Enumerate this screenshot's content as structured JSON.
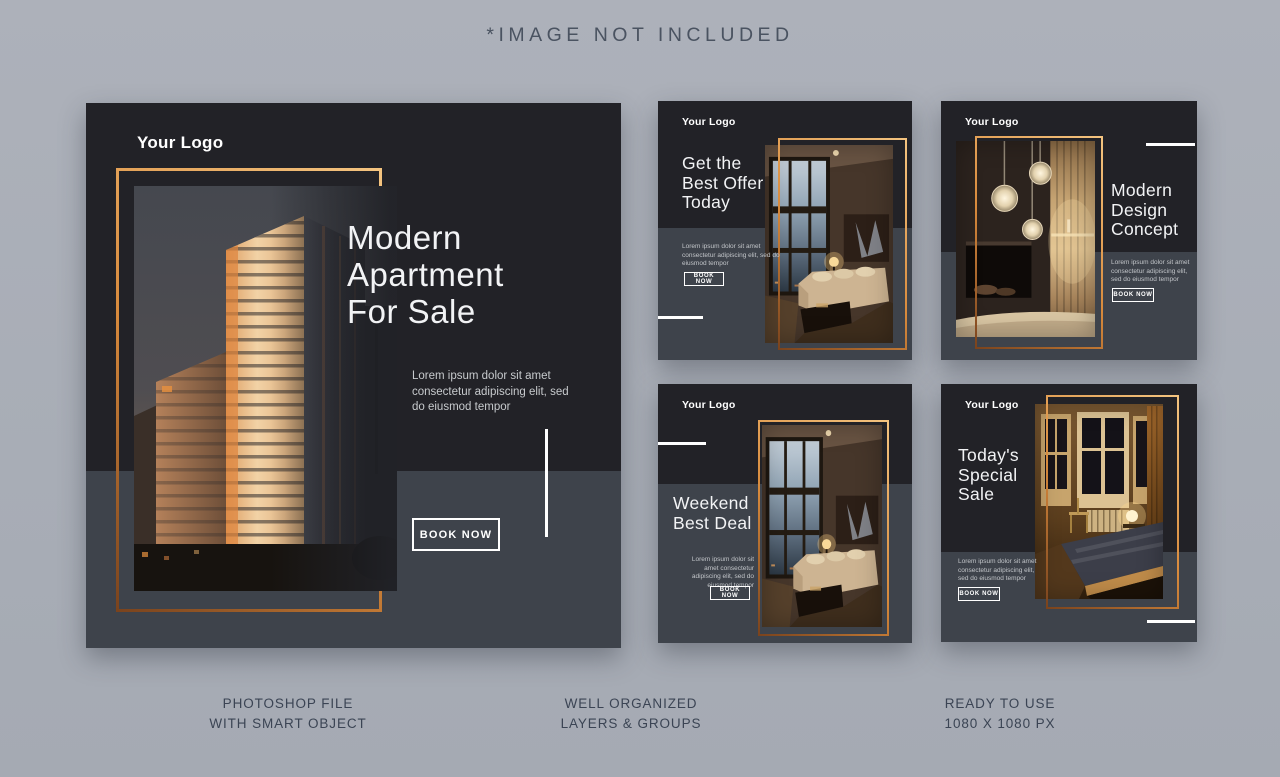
{
  "page": {
    "disclaimer": "*IMAGE NOT INCLUDED",
    "background": "#a9aeb7"
  },
  "colors": {
    "card_dark": "#222227",
    "card_light": "#3e434b",
    "gold_accent": "#d88a3c",
    "white": "#ffffff",
    "caption_text": "#3b4454"
  },
  "cards": {
    "main": {
      "logo": "Your Logo",
      "title_lines": [
        "Modern",
        "Apartment",
        "For Sale"
      ],
      "body": "Lorem ipsum dolor sit amet consectetur adipiscing elit, sed do eiusmod tempor",
      "cta": "BOOK NOW",
      "photo": "building-exterior-sunset"
    },
    "top_middle": {
      "logo": "Your Logo",
      "title_lines": [
        "Get the",
        "Best Offer",
        "Today"
      ],
      "body": "Lorem ipsum dolor sit amet consectetur adipiscing elit, sed do eiusmod tempor",
      "cta": "BOOK NOW",
      "photo": "living-room-interior"
    },
    "top_right": {
      "logo": "Your Logo",
      "title_lines": [
        "Modern",
        "Design",
        "Concept"
      ],
      "body": "Lorem ipsum dolor sit amet consectetur adipiscing elit, sed do eiusmod tempor",
      "cta": "BOOK NOW",
      "photo": "pendant-lights-interior"
    },
    "bottom_middle": {
      "logo": "Your Logo",
      "title_lines": [
        "Weekend",
        "Best Deal"
      ],
      "body": "Lorem ipsum dolor sit amet consectetur adipiscing elit, sed do eiusmod tempor",
      "cta": "BOOK NOW",
      "photo": "living-room-interior"
    },
    "bottom_right": {
      "logo": "Your Logo",
      "title_lines": [
        "Today's",
        "Special",
        "Sale"
      ],
      "body": "Lorem ipsum dolor sit amet consectetur adipiscing elit, sed do eiusmod tempor",
      "cta": "BOOK NOW",
      "photo": "bedroom-interior"
    }
  },
  "footer": {
    "items": [
      {
        "line1": "PHOTOSHOP FILE",
        "line2": "WITH SMART OBJECT"
      },
      {
        "line1": "WELL ORGANIZED",
        "line2": "LAYERS & GROUPS"
      },
      {
        "line1": "READY TO USE",
        "line2": "1080 X 1080 PX"
      }
    ]
  }
}
